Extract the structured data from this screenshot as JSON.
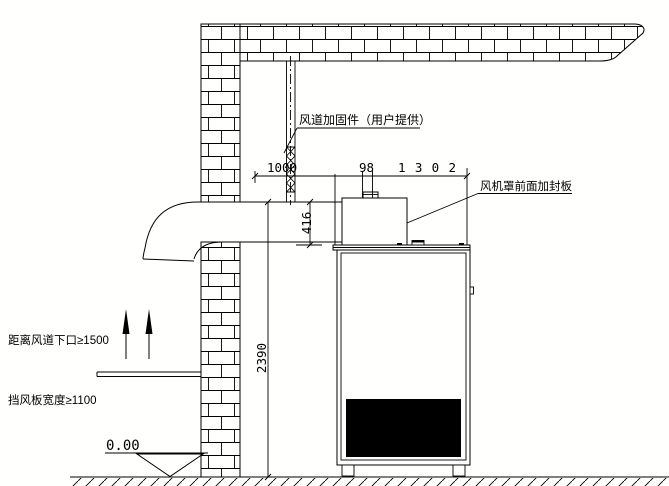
{
  "drawing": {
    "background": "#fffffe",
    "line_color": "#000000",
    "labels": {
      "duct_reinforcement": "风道加固件（用户提供）",
      "fan_hood_seal_plate": "风机罩前面加封板",
      "distance_note": "距离风道下口≥1500",
      "baffle_note": "挡风板宽度≥1100",
      "ground_level": "0.00"
    },
    "dimensions": {
      "duct_offset": "1000",
      "gap": "98",
      "unit_width": "1302",
      "duct_height": "416",
      "unit_height": "2390"
    }
  }
}
